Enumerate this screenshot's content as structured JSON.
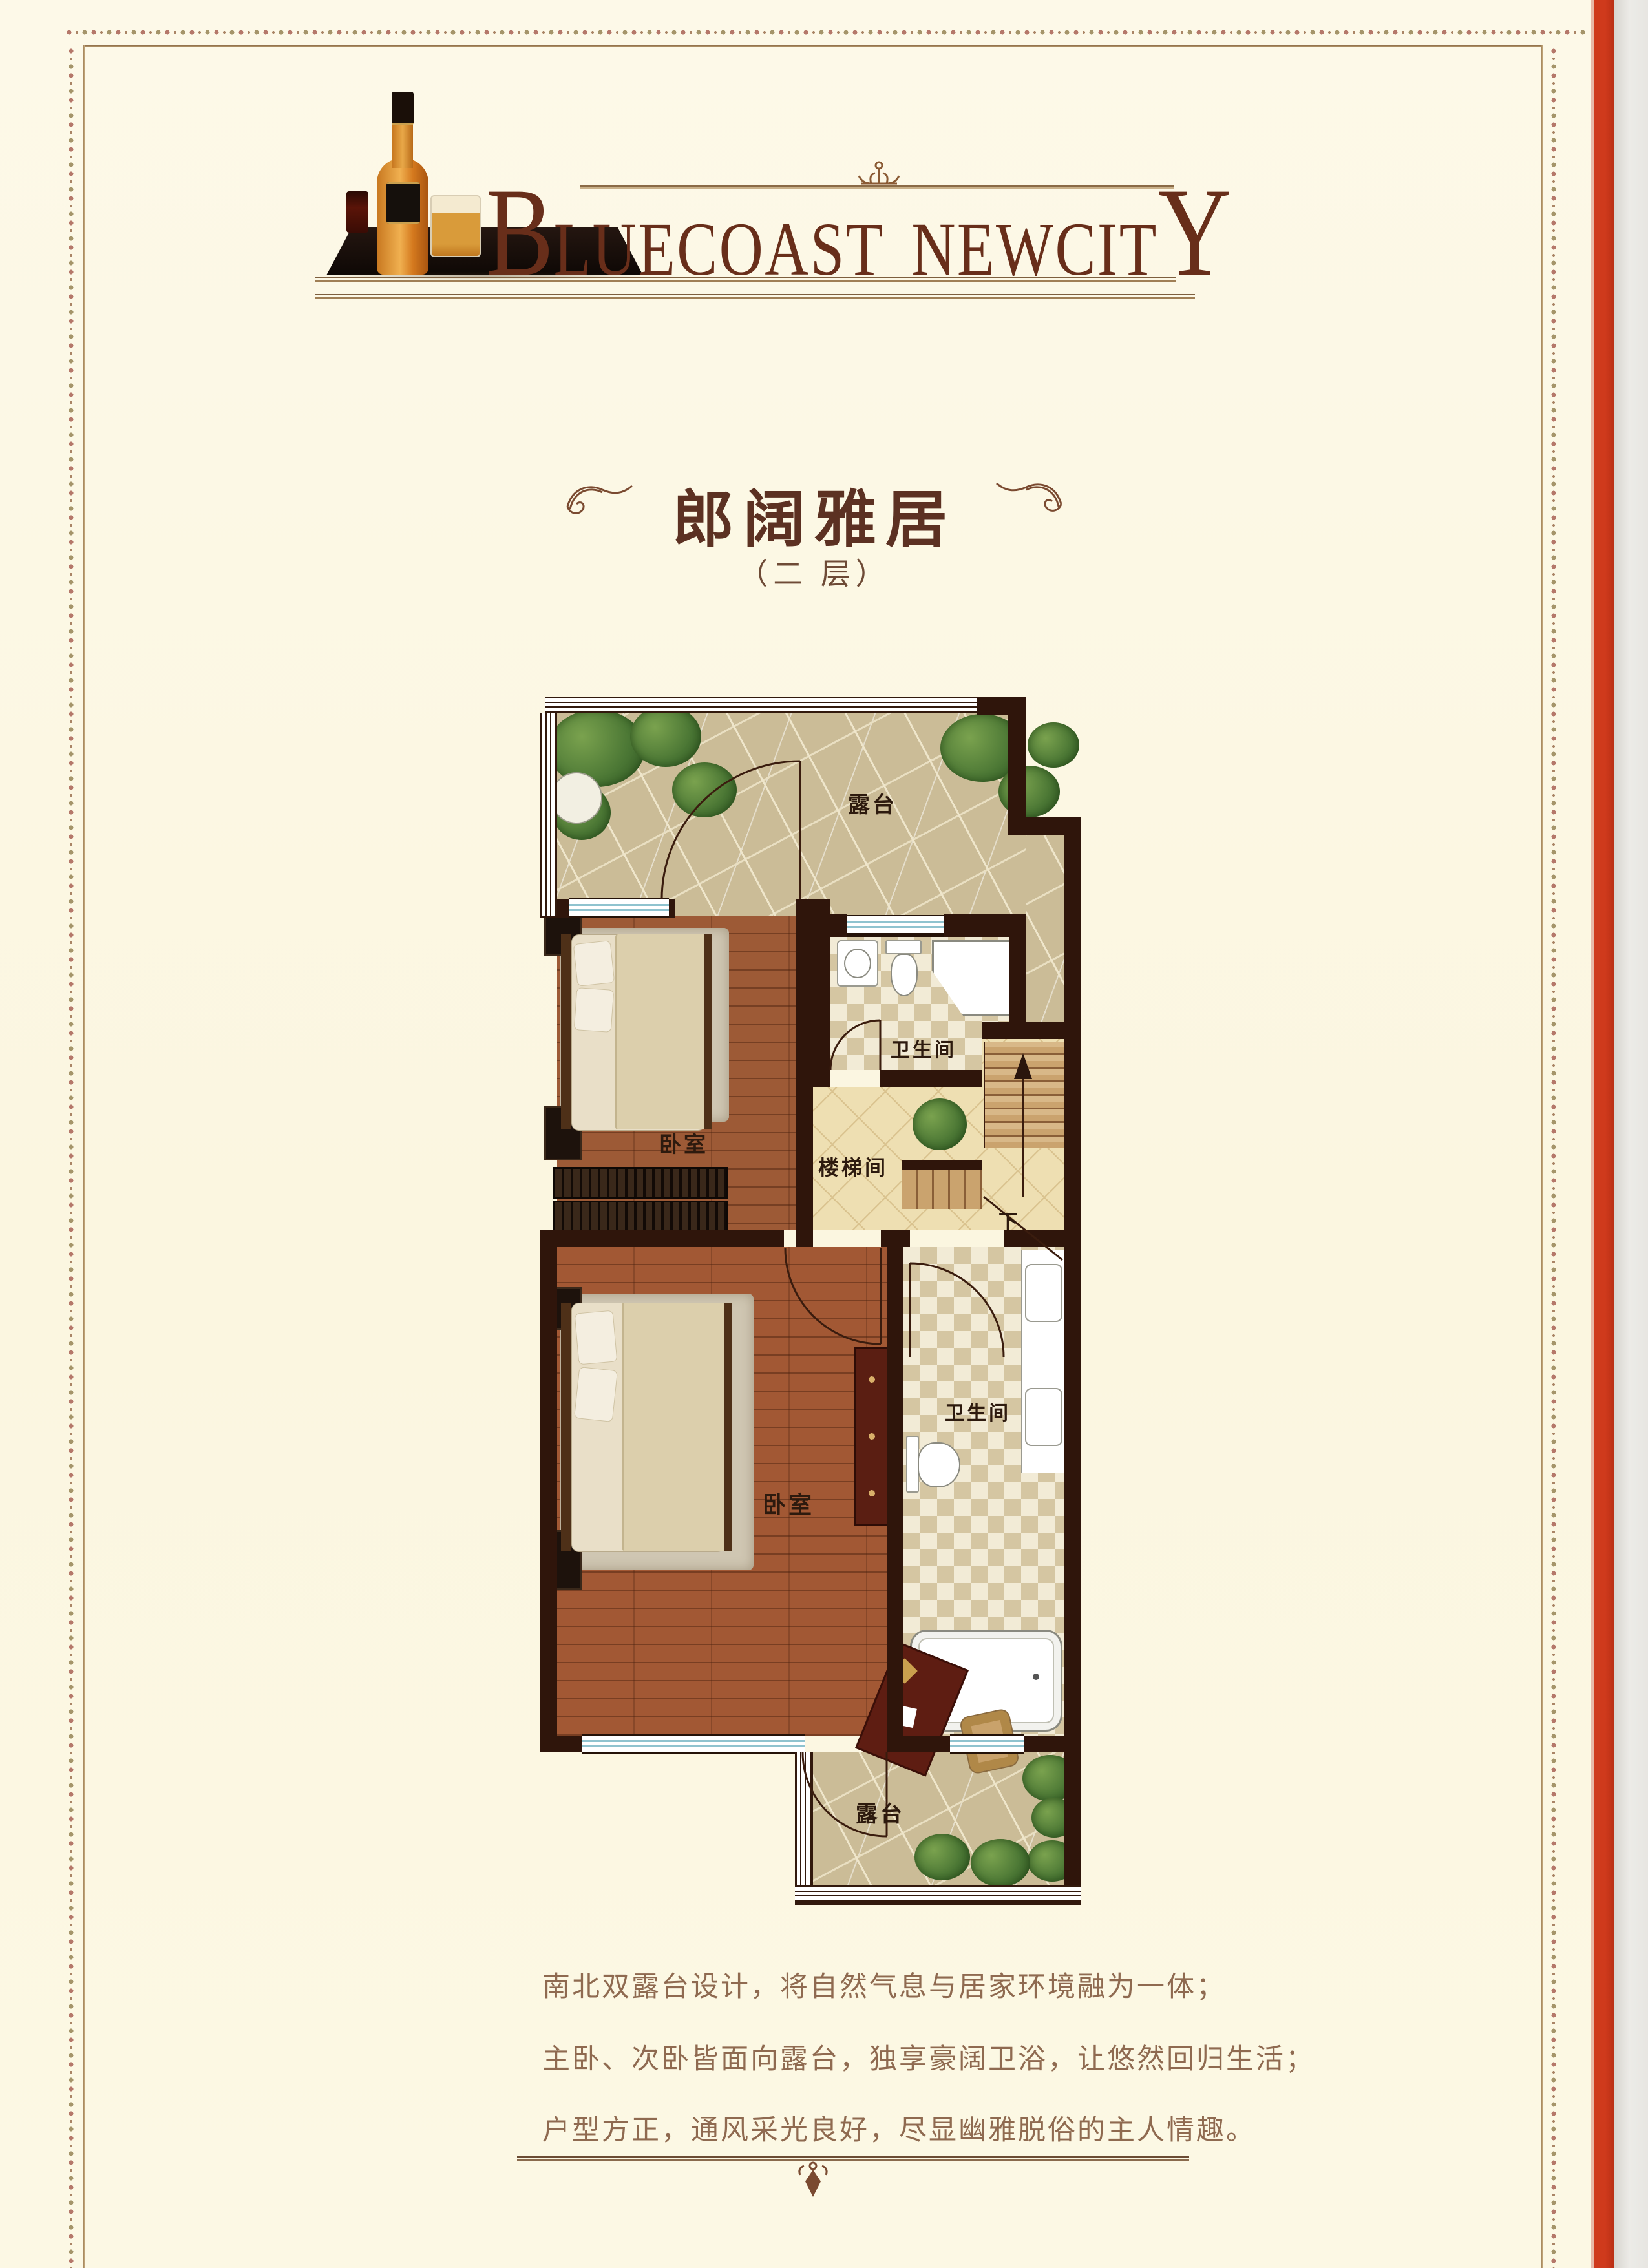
{
  "logo": {
    "part1_initial": "B",
    "part1_rest": "LUECOAST",
    "part2_rest": "NEWCIT",
    "part2_final": "Y"
  },
  "title": {
    "main": "郎阔雅居",
    "sub": "（二 层）"
  },
  "plan": {
    "labels": {
      "terrace_top": "露台",
      "bath_top": "卫生间",
      "stairwell": "楼梯间",
      "down": "下",
      "bedroom_top": "卧室",
      "bedroom_bottom": "卧室",
      "bath_bottom": "卫生间",
      "terrace_bottom": "露台"
    }
  },
  "description": {
    "lines": [
      "南北双露台设计，将自然气息与居家环境融为一体；",
      "主卧、次卧皆面向露台，独享豪阔卫浴，让悠然回归生活；",
      "户型方正，通风采光良好，尽显幽雅脱俗的主人情趣。"
    ]
  },
  "colors": {
    "accent_red": "#cf3a1c",
    "frame_tan": "#b59a6a",
    "text_brown": "#682e1a"
  }
}
